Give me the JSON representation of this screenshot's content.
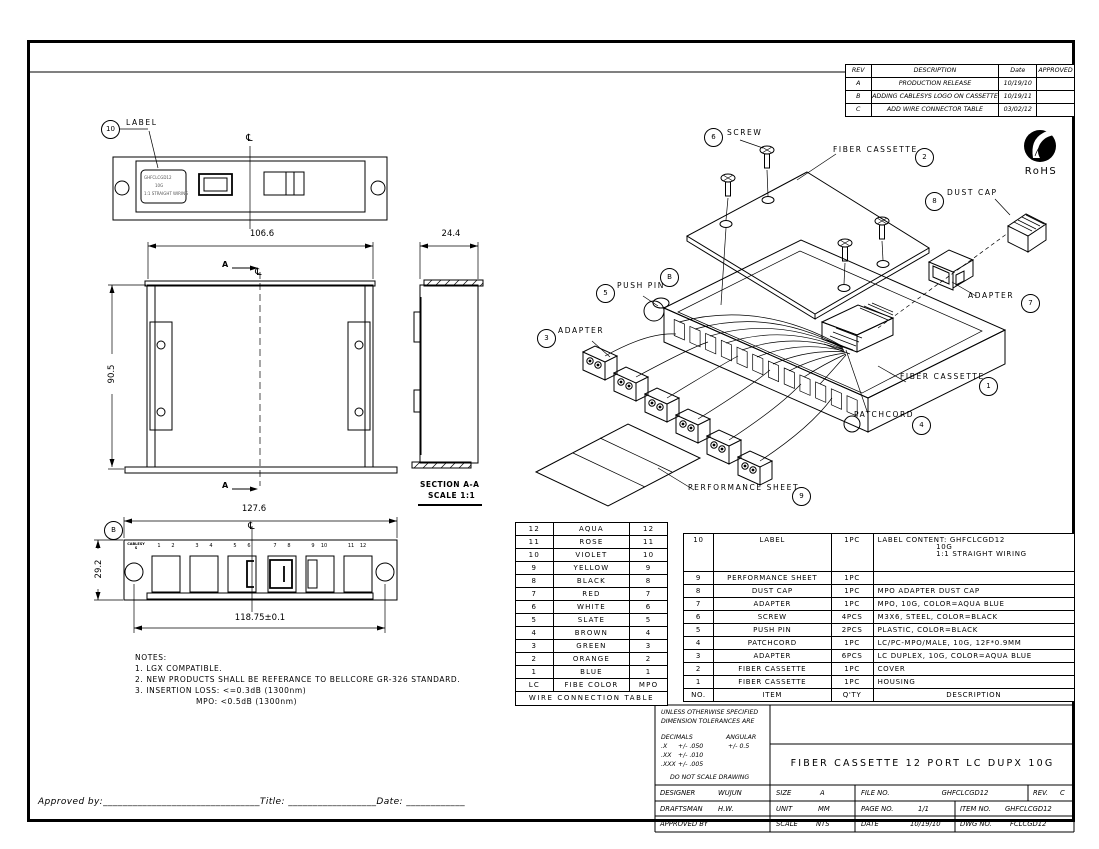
{
  "sheet": {
    "bg": "#ffffff",
    "line_color": "#000000",
    "centerline_symbol": "℄"
  },
  "revision_table": {
    "headers": {
      "rev": "REV",
      "description": "DESCRIPTION",
      "date": "Date",
      "approved": "APPROVED"
    },
    "rows": [
      {
        "rev": "A",
        "description": "PRODUCTION RELEASE",
        "date": "10/19/10",
        "approved": ""
      },
      {
        "rev": "B",
        "description": "ADDING CABLESYS LOGO ON CASSETTE",
        "date": "10/19/11",
        "approved": ""
      },
      {
        "rev": "C",
        "description": "ADD WIRE CONNECTOR TABLE",
        "date": "03/02/12",
        "approved": ""
      }
    ]
  },
  "rohs": {
    "label": "RoHS"
  },
  "rear_view": {
    "balloon": "10",
    "callout": "LABEL",
    "sticker_lines": [
      "GHFCLCGD12",
      "10G",
      "1:1 STRAIGHT WIRING"
    ]
  },
  "top_view": {
    "width_dim": "106.6",
    "height_dim": "90.5",
    "section_letter": "A"
  },
  "side_view": {
    "width_dim": "24.4",
    "caption": "SECTION A-A",
    "scale": "SCALE 1:1"
  },
  "front_view": {
    "balloon": "B",
    "width_dim": "127.6",
    "hole_span_dim": "118.75±0.1",
    "height_dim": "29.2",
    "logo": "CABLESYS",
    "port_numbers": [
      "1",
      "2",
      "3",
      "4",
      "5",
      "6",
      "7",
      "8",
      "9",
      "10",
      "11",
      "12"
    ]
  },
  "exploded": {
    "callouts": {
      "screw": {
        "num": "6",
        "label": "SCREW"
      },
      "cover": {
        "num": "2",
        "label": "FIBER CASSETTE"
      },
      "dust_cap": {
        "num": "8",
        "label": "DUST CAP"
      },
      "adapter_mpo": {
        "num": "7",
        "label": "ADAPTER"
      },
      "push_pin": {
        "num": "5",
        "label": "PUSH PIN"
      },
      "view_b": {
        "num": "B",
        "label": ""
      },
      "adapter_lc": {
        "num": "3",
        "label": "ADAPTER"
      },
      "housing": {
        "num": "1",
        "label": "FIBER CASSETTE"
      },
      "patchcord": {
        "num": "4",
        "label": "PATCHCORD"
      },
      "performance_sheet": {
        "num": "9",
        "label": "PERFORMANCE SHEET"
      }
    }
  },
  "notes": {
    "title": "NOTES:",
    "line1": "1. LGX COMPATIBLE.",
    "line2": "2. NEW PRODUCTS SHALL BE REFERANCE TO BELLCORE GR-326 STANDARD.",
    "line3": "3. INSERTION LOSS: <=0.3dB  (1300nm)",
    "line4": "MPO: <0.5dB  (1300nm)"
  },
  "wire_table": {
    "rows": [
      [
        "12",
        "AQUA",
        "12"
      ],
      [
        "11",
        "ROSE",
        "11"
      ],
      [
        "10",
        "VIOLET",
        "10"
      ],
      [
        "9",
        "YELLOW",
        "9"
      ],
      [
        "8",
        "BLACK",
        "8"
      ],
      [
        "7",
        "RED",
        "7"
      ],
      [
        "6",
        "WHITE",
        "6"
      ],
      [
        "5",
        "SLATE",
        "5"
      ],
      [
        "4",
        "BROWN",
        "4"
      ],
      [
        "3",
        "GREEN",
        "3"
      ],
      [
        "2",
        "ORANGE",
        "2"
      ],
      [
        "1",
        "BLUE",
        "1"
      ],
      [
        "LC",
        "FIBE COLOR",
        "MPO"
      ]
    ],
    "footer": "WIRE CONNECTION TABLE"
  },
  "bom": {
    "headers": [
      "NO.",
      "ITEM",
      "Q'TY",
      "DESCRIPTION"
    ],
    "rows": [
      [
        "10",
        "LABEL",
        "1PC",
        "LABEL CONTENT: GHFCLCGD12\n                    10G\n                    1:1 STRAIGHT WIRING"
      ],
      [
        "9",
        "PERFORMANCE SHEET",
        "1PC",
        ""
      ],
      [
        "8",
        "DUST CAP",
        "1PC",
        "MPO ADAPTER DUST CAP"
      ],
      [
        "7",
        "ADAPTER",
        "1PC",
        "MPO, 10G, COLOR=AQUA BLUE"
      ],
      [
        "6",
        "SCREW",
        "4PCS",
        "M3X6, STEEL, COLOR=BLACK"
      ],
      [
        "5",
        "PUSH PIN",
        "2PCS",
        "PLASTIC, COLOR=BLACK"
      ],
      [
        "4",
        "PATCHCORD",
        "1PC",
        "LC/PC-MPO/MALE, 10G, 12F*0.9MM"
      ],
      [
        "3",
        "ADAPTER",
        "6PCS",
        "LC DUPLEX, 10G, COLOR=AQUA BLUE"
      ],
      [
        "2",
        "FIBER CASSETTE",
        "1PC",
        "COVER"
      ],
      [
        "1",
        "FIBER CASSETTE",
        "1PC",
        "HOUSING"
      ]
    ]
  },
  "tolerances": {
    "line1": "UNLESS OTHERWISE SPECIFIED",
    "line2": "DIMENSION TOLERANCES ARE",
    "decimals_label": "DECIMALS",
    "angular_label": "ANGULAR",
    "x": ".X",
    "x_tol": "+/- .050",
    "angular_tol": "+/- 0.5",
    "xx": ".XX",
    "xx_tol": "+/- .010",
    "xxx": ".XXX",
    "xxx_tol": "+/- .005",
    "footer": "DO NOT SCALE DRAWING"
  },
  "title_block": {
    "title": "FIBER CASSETTE 12 PORT LC DUPX 10G",
    "designer_label": "DESIGNER",
    "designer": "WUJUN",
    "draftsman_label": "DRAFTSMAN",
    "draftsman": "H.W.",
    "approved_label": "APPROVED BY",
    "approved": "",
    "size_label": "SIZE",
    "size": "A",
    "unit_label": "UNIT",
    "unit": "MM",
    "scale_label": "SCALE",
    "scale": "NTS",
    "file_label": "FILE NO.",
    "file_no": "GHFCLCGD12",
    "rev_label": "REV.",
    "rev": "C",
    "page_label": "PAGE NO.",
    "page": "1/1",
    "item_label": "ITEM NO.",
    "item_no": "GHFCLCGD12",
    "date_label": "DATE",
    "date": "10/19/10",
    "dwg_label": "DWG NO.",
    "dwg_no": "FCLCGD12"
  },
  "approval_line": {
    "approved_by": "Approved by:",
    "blank1": "________________________________",
    "title_label": "Title:",
    "blank2": "__________________",
    "date_label": "Date:",
    "blank3": "____________"
  }
}
